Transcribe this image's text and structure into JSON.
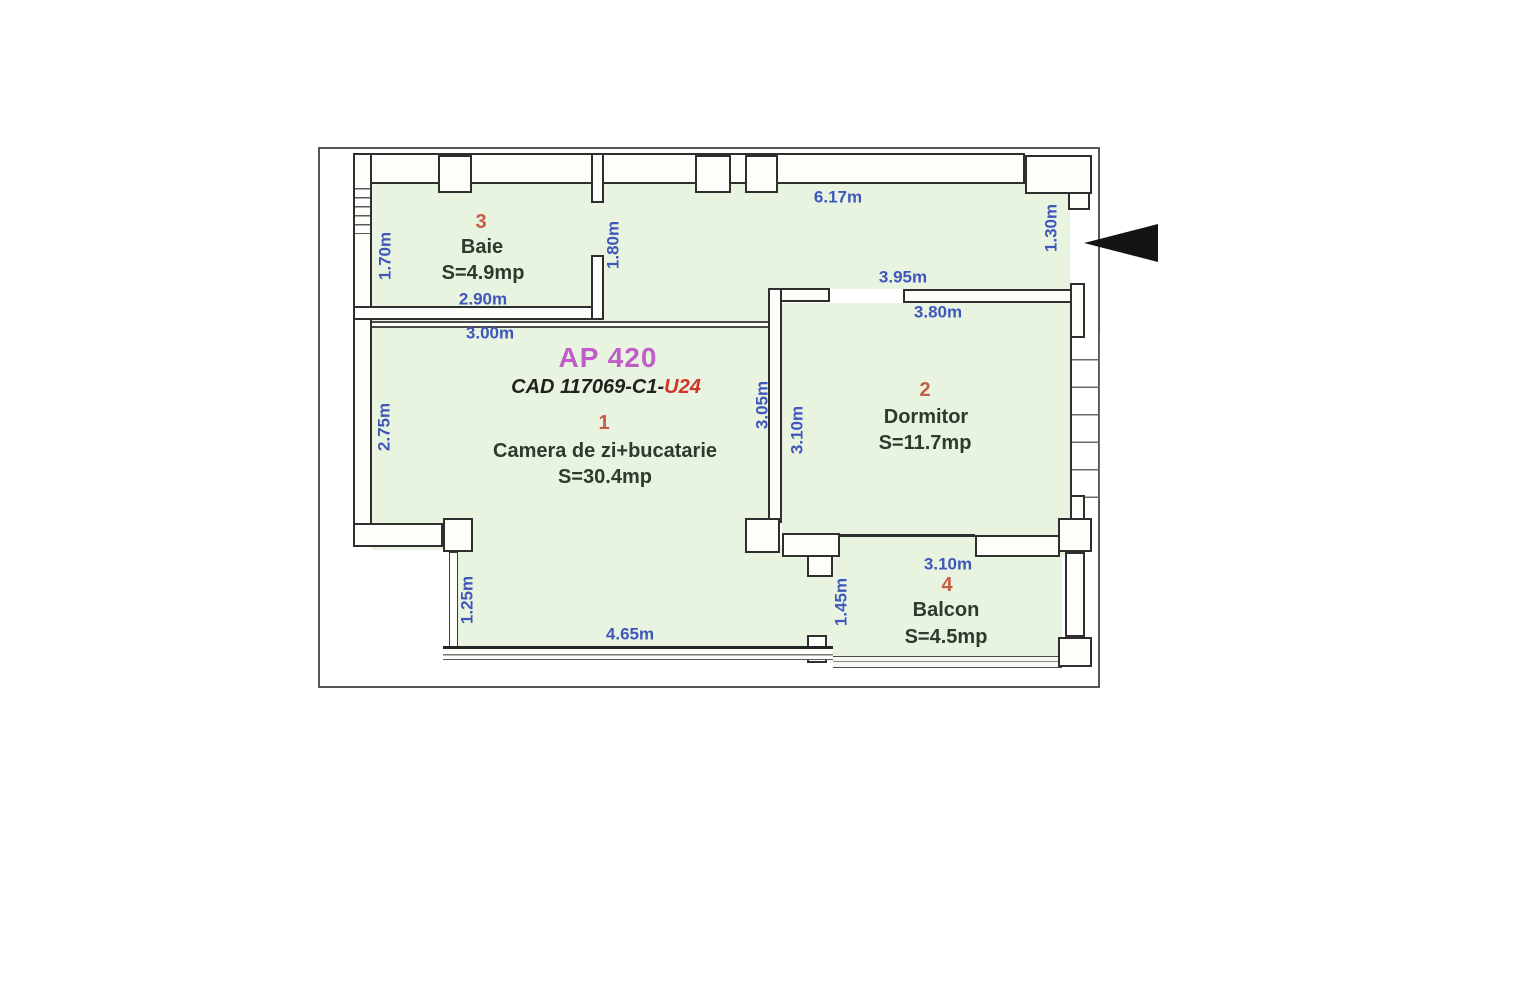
{
  "plan": {
    "title": "AP 420",
    "cad": {
      "prefix": "CAD 117069-C1-",
      "unit": "U24"
    },
    "rooms": [
      {
        "number": "1",
        "name": "Camera de zi+bucatarie",
        "area": "S=30.4mp"
      },
      {
        "number": "2",
        "name": "Dormitor",
        "area": "S=11.7mp"
      },
      {
        "number": "3",
        "name": "Baie",
        "area": "S=4.9mp"
      },
      {
        "number": "4",
        "name": "Balcon",
        "area": "S=4.5mp"
      }
    ],
    "dims": {
      "top_width": "6.17m",
      "entrance_width": "1.30m",
      "baie_width": "2.90m",
      "below_baie_wall": "3.00m",
      "baie_height": "1.70m",
      "baie_right": "1.80m",
      "living_left": "2.75m",
      "dormitor_top_outer": "3.95m",
      "dormitor_top_inner": "3.80m",
      "divider_left": "3.05m",
      "dormitor_left": "3.10m",
      "living_bottom_left": "1.25m",
      "living_bottom_window": "4.65m",
      "balcon_door": "1.45m",
      "balcon_width": "3.10m"
    },
    "colors": {
      "floor": "#e9f4e0",
      "dimension_text": "#3f56bb",
      "room_number": "#c65b47",
      "room_text": "#2e3a2e",
      "title": "#c05ec9",
      "cad_unit": "#cf3526",
      "wall_stroke": "#2f2f2f"
    },
    "icons": {
      "entrance_arrow": "left-pointing-solid-triangle"
    }
  }
}
